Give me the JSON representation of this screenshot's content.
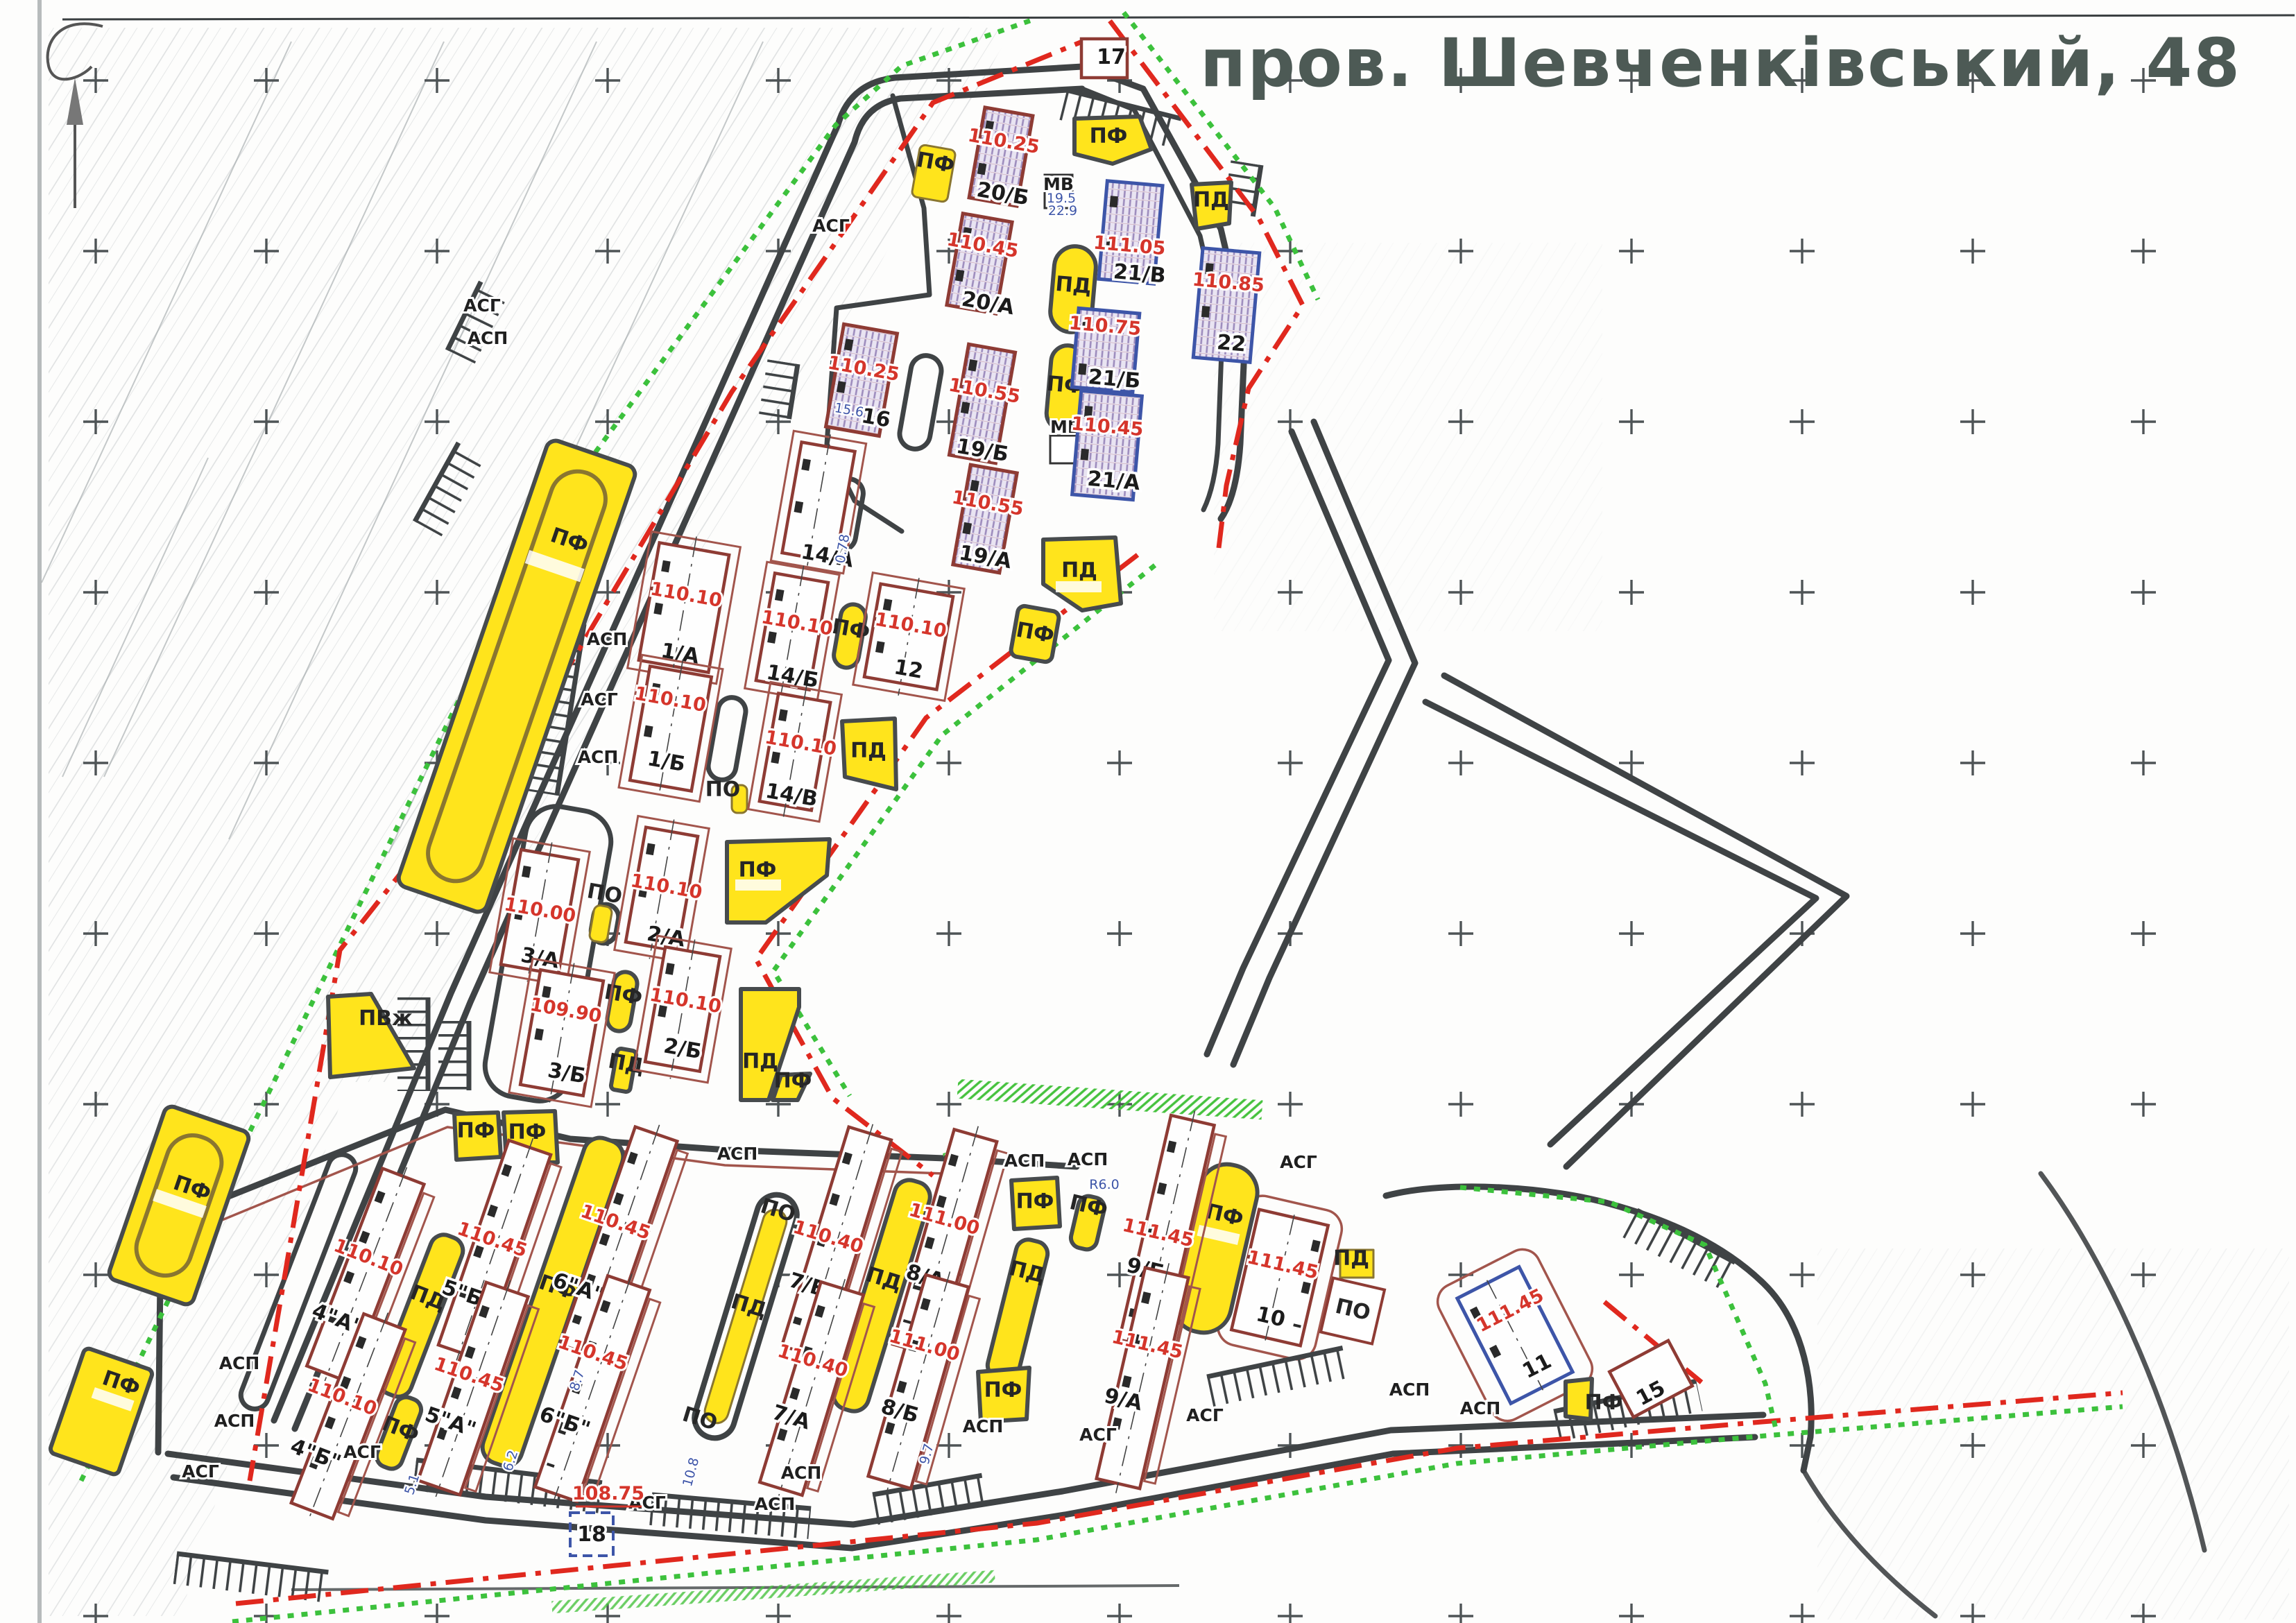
{
  "title": "пров. Шевченківський, 48",
  "area_types": {
    "pf": "ПФ",
    "pd": "ПД",
    "po": "ПО",
    "pvzh": "ПВж",
    "mv": "МВ"
  },
  "parking_types": {
    "asg": "АСГ",
    "asp": "АСП"
  },
  "buildings": {
    "b17": {
      "label": "17"
    },
    "b18": {
      "label": "18"
    },
    "b15": {
      "label": "15"
    },
    "b20b": {
      "label": "20/Б",
      "elev": "110.25"
    },
    "b20a": {
      "label": "20/А",
      "elev": "110.45"
    },
    "b21v": {
      "label": "21/В",
      "elev": "111.05"
    },
    "b21b": {
      "label": "21/Б",
      "elev": "110.75"
    },
    "b21a": {
      "label": "21/А",
      "elev": "110.45"
    },
    "b22": {
      "label": "22",
      "elev": "110.85"
    },
    "b16": {
      "label": "16",
      "elev": "110.25",
      "dim": "15.6"
    },
    "b19b": {
      "label": "19/Б",
      "elev": "110.55"
    },
    "b19a": {
      "label": "19/А",
      "elev": "110.55"
    },
    "b14a": {
      "label": "14/А",
      "dim": "0.78"
    },
    "b14b": {
      "label": "14/Б",
      "elev": "110.10"
    },
    "b14v": {
      "label": "14/В",
      "elev": "110.10"
    },
    "b12": {
      "label": "12",
      "elev": "110.10"
    },
    "b1a": {
      "label": "1/А",
      "elev": "110.10"
    },
    "b1b": {
      "label": "1/Б",
      "elev": "110.10"
    },
    "b2a": {
      "label": "2/А",
      "elev": "110.10"
    },
    "b2b": {
      "label": "2/Б",
      "elev": "110.10"
    },
    "b3a": {
      "label": "3/А",
      "elev": "110.00"
    },
    "b3b": {
      "label": "3/Б",
      "elev": "109.90"
    },
    "b4a": {
      "label": "4\"А\"",
      "elev": "110.10"
    },
    "b4b": {
      "label": "4\"Б\"",
      "elev": "110.10"
    },
    "b5b": {
      "label": "5\"Б\"",
      "elev": "110.45"
    },
    "b5a": {
      "label": "5\"А\"",
      "elev": "110.45"
    },
    "b6a": {
      "label": "6\"А\"",
      "elev": "110.45"
    },
    "b6b": {
      "label": "6\"Б\"",
      "elev": "110.45"
    },
    "b7b": {
      "label": "7/Б",
      "elev": "110.40"
    },
    "b7a": {
      "label": "7/А",
      "elev": "110.40"
    },
    "b8a": {
      "label": "8/А",
      "elev": "111.00"
    },
    "b8b": {
      "label": "8/Б",
      "elev": "111.00"
    },
    "b9b": {
      "label": "9/Б",
      "elev": "111.45"
    },
    "b9a": {
      "label": "9/А",
      "elev": "111.45"
    },
    "b10": {
      "label": "10",
      "elev": "111.45"
    },
    "b11": {
      "label": "11",
      "elev": "111.45"
    }
  },
  "spot_elevations": {
    "road": "108.75"
  },
  "mv_dims": {
    "d1": "19.5",
    "d2": "22.9"
  },
  "blue_dims": {
    "d1": "5.1",
    "d2": "10.8",
    "d3": "9.7",
    "d4": "6.2",
    "d5": "8.7",
    "d6": "R6.0"
  },
  "colors": {
    "site_yellow": "#ffe41c",
    "boundary_red": "#e0281e",
    "boundary_green": "#3cc13c",
    "building_outline_red": "#8e3b34",
    "building_outline_blue": "#3d55a8",
    "road_dark": "#3f4345",
    "elevation_red": "#d5352b",
    "title_gray": "#4d5a55"
  }
}
